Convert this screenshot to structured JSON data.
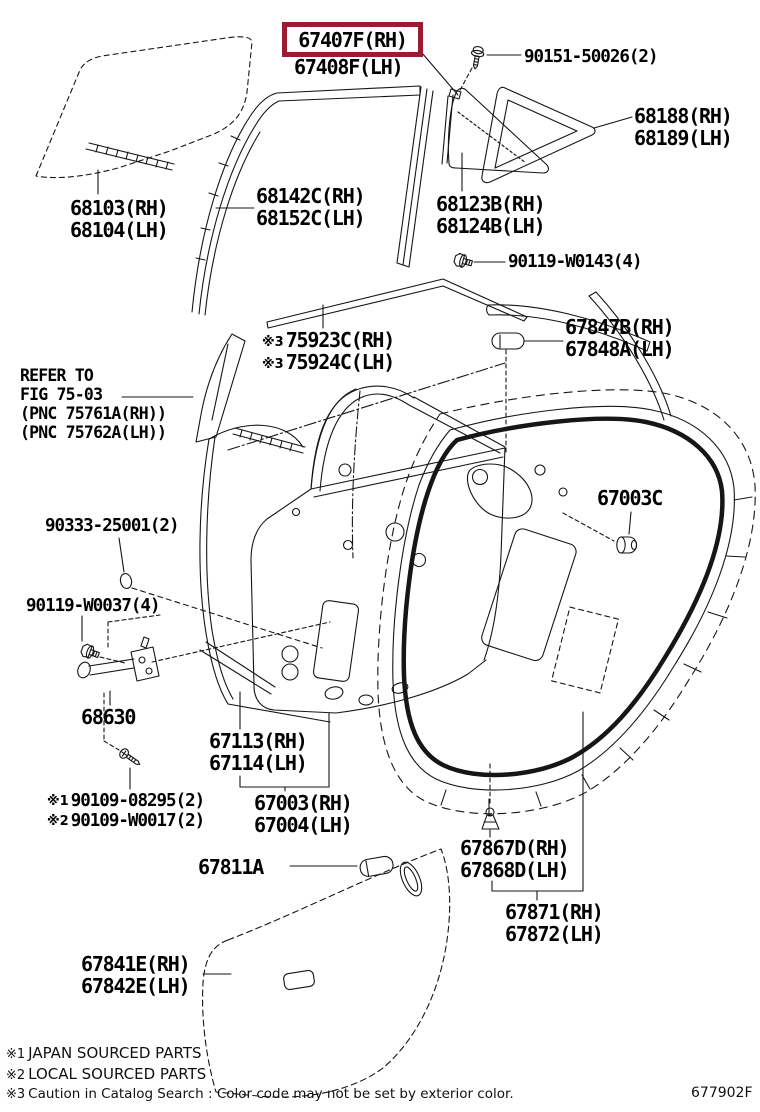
{
  "highlight": {
    "color": "#9b1b32",
    "style": "border-color:#9b1b32"
  },
  "doc_number": "677902F",
  "footnotes": [
    {
      "prefix": "※1",
      "text": "JAPAN SOURCED PARTS"
    },
    {
      "prefix": "※2",
      "text": "LOCAL SOURCED PARTS"
    },
    {
      "prefix": "※3",
      "text": "Caution in Catalog Search : Color code may not be set by exterior color."
    }
  ],
  "parts": {
    "p67407": {
      "rh": "67407F(RH)",
      "lh": "67408F(LH)"
    },
    "p90151": {
      "num": "90151-50026(2)"
    },
    "p68188": {
      "rh": "68188(RH)",
      "lh": "68189(LH)"
    },
    "p68123": {
      "rh": "68123B(RH)",
      "lh": "68124B(LH)"
    },
    "p90119w0143": {
      "num": "90119-W0143(4)"
    },
    "p68103": {
      "rh": "68103(RH)",
      "lh": "68104(LH)"
    },
    "p68142": {
      "rh": "68142C(RH)",
      "lh": "68152C(LH)"
    },
    "p75923": {
      "prefix": "※3",
      "rh": "75923C(RH)",
      "lh": "75924C(LH)"
    },
    "refer": {
      "line1": "REFER TO",
      "line2": "FIG 75-03",
      "line3": "(PNC 75761A(RH))",
      "line4": "(PNC 75762A(LH))"
    },
    "p67847": {
      "rh": "67847B(RH)",
      "lh": "67848A(LH)"
    },
    "p67003c": {
      "num": "67003C"
    },
    "p90333": {
      "num": "90333-25001(2)"
    },
    "p90119w0037": {
      "num": "90119-W0037(4)"
    },
    "p68630": {
      "num": "68630"
    },
    "p90109_1": {
      "prefix": "※1",
      "num": "90109-08295(2)"
    },
    "p90109_2": {
      "prefix": "※2",
      "num": "90109-W0017(2)"
    },
    "p67113": {
      "rh": "67113(RH)",
      "lh": "67114(LH)"
    },
    "p67003": {
      "rh": "67003(RH)",
      "lh": "67004(LH)"
    },
    "p67811": {
      "num": "67811A"
    },
    "p67841": {
      "rh": "67841E(RH)",
      "lh": "67842E(LH)"
    },
    "p67867": {
      "rh": "67867D(RH)",
      "lh": "67868D(LH)"
    },
    "p67871": {
      "rh": "67871(RH)",
      "lh": "67872(LH)"
    }
  }
}
